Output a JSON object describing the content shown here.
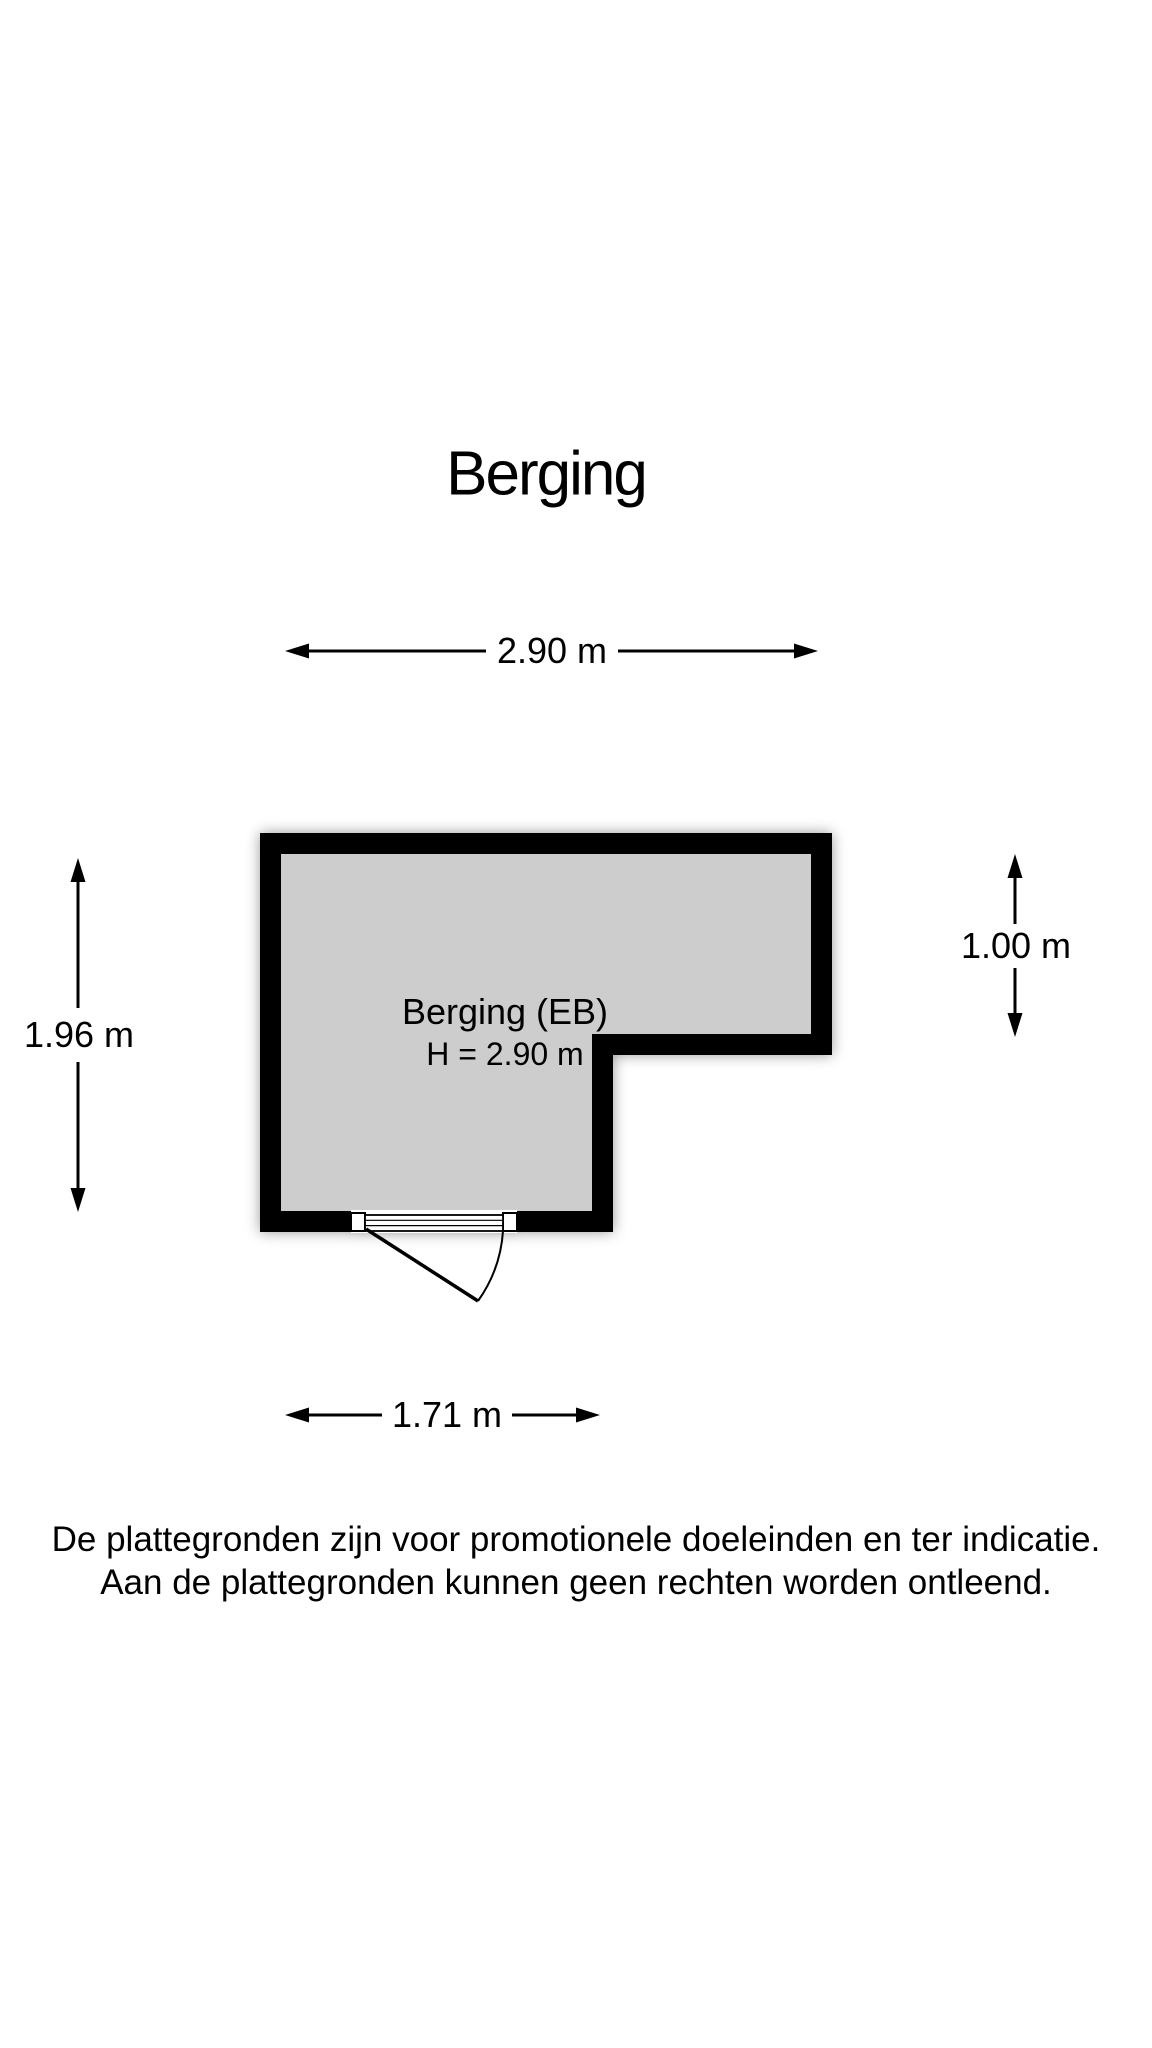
{
  "title": "Berging",
  "floorplan": {
    "room_label_line1": "Berging (EB)",
    "room_label_line2": "H = 2.90 m",
    "fill_color": "#cdcdcd",
    "wall_color": "#000000",
    "door_color": "#000000",
    "background_color": "#ffffff"
  },
  "dimensions": {
    "top": "2.90 m",
    "left": "1.96 m",
    "right": "1.00 m",
    "bottom": "1.71 m"
  },
  "footer": {
    "line1": "De plattegronden zijn voor promotionele doeleinden en ter indicatie.",
    "line2": "Aan de plattegronden kunnen geen rechten worden ontleend."
  }
}
